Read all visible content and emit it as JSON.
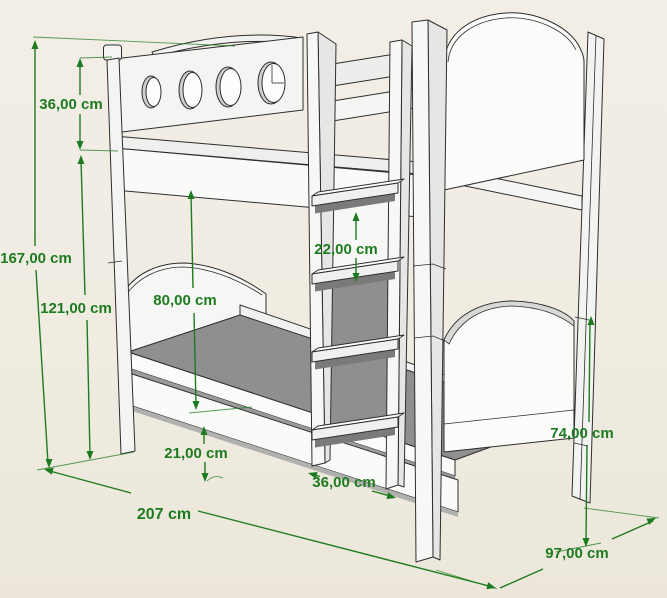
{
  "figure": {
    "subject": "Bunk bed technical dimension drawing",
    "unit": "cm",
    "background_color": "#f0ece2",
    "outline_color": "#2e2e2e",
    "dimension_color": "#1e7b20",
    "mattress_color": "#8f8f8f",
    "porthole_count": 4,
    "ladder_rung_count": 4
  },
  "dimensions": {
    "guardrail_height": {
      "label": "36,00 cm",
      "value": 36
    },
    "total_height": {
      "label": "167,00 cm",
      "value": 167
    },
    "upper_frame_height": {
      "label": "121,00 cm",
      "value": 121
    },
    "bunk_clearance": {
      "label": "80,00 cm",
      "value": 80
    },
    "rung_spacing": {
      "label": "22,00 cm",
      "value": 22
    },
    "floor_gap": {
      "label": "21,00 cm",
      "value": 21
    },
    "ladder_width": {
      "label": "36,00 cm",
      "value": 36
    },
    "footboard_height": {
      "label": "74,00 cm",
      "value": 74
    },
    "bed_length": {
      "label": "207 cm",
      "value": 207
    },
    "bed_depth": {
      "label": "97,00 cm",
      "value": 97
    }
  }
}
